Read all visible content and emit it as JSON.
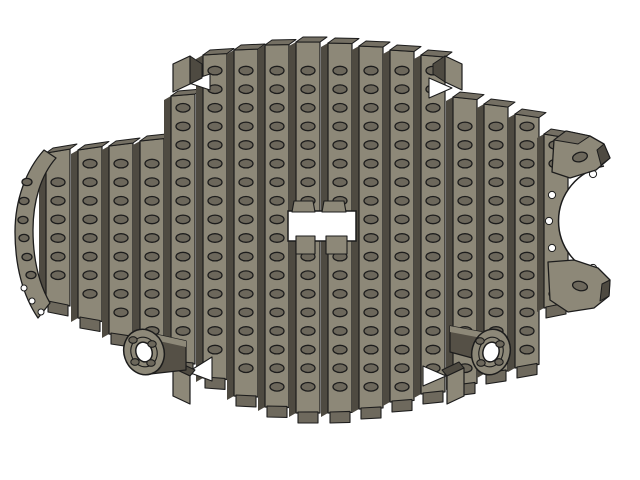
{
  "scene": {
    "width": 640,
    "height": 480,
    "background": "#ffffff",
    "description": "Shaded 3D CAD render of a slatted fish-shaped assembly with counterbored holes, left fin, clawed right end, two bolt-flange wheel hubs and a rectangular center cutout"
  },
  "colors": {
    "face": "#8d8878",
    "top": "#746f63",
    "side": "#4e4a41",
    "foot": "#6e695d",
    "hole": "#6c675b",
    "cyl": "#555046",
    "outline": "#1c1c1c",
    "white": "#ffffff"
  },
  "model": {
    "holes": {
      "row_start": 52,
      "row_pitch": 18.6,
      "rx": 7,
      "ry": 4.3,
      "margin_top": 11,
      "margin_bottom": 13,
      "row_count": 20
    },
    "slats": {
      "face_width": 24,
      "side_width": 7,
      "foot_half": 10,
      "foot_depth": 11,
      "center_x": 306,
      "columns": [
        {
          "x": 58,
          "top": 153,
          "bottom": 302
        },
        {
          "x": 90,
          "top": 150,
          "bottom": 318
        },
        {
          "x": 121,
          "top": 146,
          "bottom": 334
        },
        {
          "x": 152,
          "top": 141,
          "bottom": 347
        },
        {
          "x": 183,
          "top": 96,
          "bottom": 362
        },
        {
          "x": 215,
          "top": 55,
          "bottom": 378
        },
        {
          "x": 246,
          "top": 50,
          "bottom": 396
        },
        {
          "x": 277,
          "top": 45,
          "bottom": 407
        },
        {
          "x": 308,
          "top": 42,
          "bottom": 413,
          "skip": [
            9,
            10
          ]
        },
        {
          "x": 340,
          "top": 43,
          "bottom": 413,
          "skip": [
            9,
            10
          ]
        },
        {
          "x": 371,
          "top": 46,
          "bottom": 409
        },
        {
          "x": 402,
          "top": 50,
          "bottom": 402
        },
        {
          "x": 433,
          "top": 55,
          "bottom": 394
        },
        {
          "x": 465,
          "top": 97,
          "bottom": 386
        },
        {
          "x": 496,
          "top": 104,
          "bottom": 374
        },
        {
          "x": 527,
          "top": 114,
          "bottom": 368
        },
        {
          "x": 556,
          "top": 134,
          "bottom": 308,
          "skip": [
            7,
            8,
            9,
            10,
            11
          ]
        }
      ]
    },
    "fin": {
      "path": "M 44,150 C 26,170 15,200 15,232 C 15,266 23,296 38,318 L 50,303 C 38,282 33,257 33,230 C 33,201 41,175 56,158 Z",
      "holes": [
        [
          27,
          182
        ],
        [
          24,
          201
        ],
        [
          23,
          220
        ],
        [
          24,
          238
        ],
        [
          27,
          257
        ],
        [
          31,
          275
        ]
      ],
      "hole_rx": 5,
      "hole_ry": 3.6,
      "nicks": [
        [
          24,
          288
        ],
        [
          32,
          301
        ],
        [
          41,
          312
        ]
      ]
    },
    "cutout": {
      "x": 288,
      "y": 211,
      "w": 68,
      "h": 30,
      "feet": [
        [
          [
            294,
            201
          ],
          [
            313,
            201
          ],
          [
            315,
            212
          ],
          [
            292,
            212
          ]
        ],
        [
          [
            324,
            201
          ],
          [
            344,
            201
          ],
          [
            346,
            212
          ],
          [
            322,
            212
          ]
        ]
      ],
      "stubs": [
        [
          [
            296,
            236
          ],
          [
            315,
            236
          ],
          [
            315,
            254
          ],
          [
            296,
            254
          ]
        ],
        [
          [
            326,
            236
          ],
          [
            347,
            236
          ],
          [
            347,
            254
          ],
          [
            326,
            254
          ]
        ]
      ]
    },
    "tabs": [
      {
        "face": [
          [
            173,
            64
          ],
          [
            190,
            56
          ],
          [
            190,
            84
          ],
          [
            173,
            92
          ]
        ],
        "side": [
          [
            190,
            56
          ],
          [
            202,
            64
          ],
          [
            202,
            78
          ],
          [
            190,
            84
          ]
        ]
      },
      {
        "face": [
          [
            445,
            56
          ],
          [
            462,
            64
          ],
          [
            462,
            90
          ],
          [
            445,
            82
          ]
        ],
        "side": [
          [
            433,
            64
          ],
          [
            445,
            56
          ],
          [
            445,
            82
          ],
          [
            433,
            74
          ]
        ]
      },
      {
        "face": [
          [
            173,
            368
          ],
          [
            190,
            376
          ],
          [
            190,
            404
          ],
          [
            173,
            396
          ]
        ],
        "side": [
          [
            173,
            368
          ],
          [
            190,
            376
          ],
          [
            195,
            370
          ],
          [
            178,
            362
          ]
        ]
      },
      {
        "face": [
          [
            447,
            376
          ],
          [
            464,
            368
          ],
          [
            464,
            396
          ],
          [
            447,
            404
          ]
        ],
        "side": [
          [
            447,
            376
          ],
          [
            464,
            368
          ],
          [
            459,
            362
          ],
          [
            442,
            370
          ]
        ]
      }
    ],
    "wedges": [
      [
        [
          186,
          82
        ],
        [
          210,
          74
        ],
        [
          210,
          90
        ]
      ],
      [
        [
          452,
          88
        ],
        [
          429,
          78
        ],
        [
          429,
          98
        ]
      ],
      [
        [
          188,
          372
        ],
        [
          212,
          357
        ],
        [
          212,
          381
        ]
      ],
      [
        [
          446,
          376
        ],
        [
          423,
          366
        ],
        [
          423,
          386
        ]
      ]
    ],
    "claw": {
      "notch_fill": "M 604,166 A 56,56 0 0 0 604,276 L 626,276 L 626,166 Z",
      "notch_arc": "M 604,166 A 56,56 0 0 0 604,276",
      "nicks": [
        [
          552,
          195
        ],
        [
          549,
          221
        ],
        [
          552,
          248
        ],
        [
          593,
          174
        ],
        [
          593,
          268
        ]
      ],
      "top_prong": {
        "face": [
          [
            552,
            172
          ],
          [
            554,
            140
          ],
          [
            566,
            131
          ],
          [
            590,
            136
          ],
          [
            604,
            144
          ],
          [
            610,
            158
          ],
          [
            596,
            170
          ],
          [
            570,
            178
          ]
        ],
        "cap": [
          [
            554,
            140
          ],
          [
            566,
            131
          ],
          [
            590,
            136
          ],
          [
            578,
            144
          ]
        ],
        "side": [
          [
            604,
            144
          ],
          [
            610,
            158
          ],
          [
            601,
            165
          ],
          [
            597,
            150
          ]
        ],
        "hole": [
          580,
          157,
          -15
        ]
      },
      "bottom_prong": {
        "face": [
          [
            548,
            262
          ],
          [
            574,
            260
          ],
          [
            598,
            268
          ],
          [
            610,
            280
          ],
          [
            609,
            296
          ],
          [
            594,
            308
          ],
          [
            568,
            312
          ],
          [
            550,
            300
          ]
        ],
        "side": [
          [
            610,
            280
          ],
          [
            609,
            296
          ],
          [
            600,
            301
          ],
          [
            602,
            284
          ]
        ],
        "hole": [
          580,
          286,
          12
        ]
      }
    },
    "hubs": [
      {
        "cyl": [
          [
            150,
            333
          ],
          [
            186,
            341
          ],
          [
            186,
            370
          ],
          [
            150,
            374
          ]
        ],
        "band": [
          [
            150,
            333
          ],
          [
            186,
            341
          ],
          [
            186,
            347
          ],
          [
            150,
            339
          ]
        ],
        "cx": 144,
        "cy": 352,
        "rx": 20,
        "ry": 23,
        "rot": -18,
        "rim": [
          13,
          15
        ],
        "hole": [
          8,
          10
        ],
        "bolts": [
          [
            133,
            340
          ],
          [
            152,
            344
          ],
          [
            135,
            362
          ],
          [
            151,
            363
          ]
        ]
      },
      {
        "cyl": [
          [
            450,
            326
          ],
          [
            487,
            333
          ],
          [
            487,
            362
          ],
          [
            450,
            352
          ]
        ],
        "band": [
          [
            450,
            326
          ],
          [
            487,
            333
          ],
          [
            487,
            339
          ],
          [
            450,
            332
          ]
        ],
        "cx": 491,
        "cy": 352,
        "rx": 19,
        "ry": 23,
        "rot": 15,
        "rim": [
          12,
          15
        ],
        "hole": [
          8,
          10
        ],
        "bolts": [
          [
            480,
            341
          ],
          [
            500,
            344
          ],
          [
            481,
            363
          ],
          [
            499,
            362
          ]
        ]
      }
    ]
  }
}
